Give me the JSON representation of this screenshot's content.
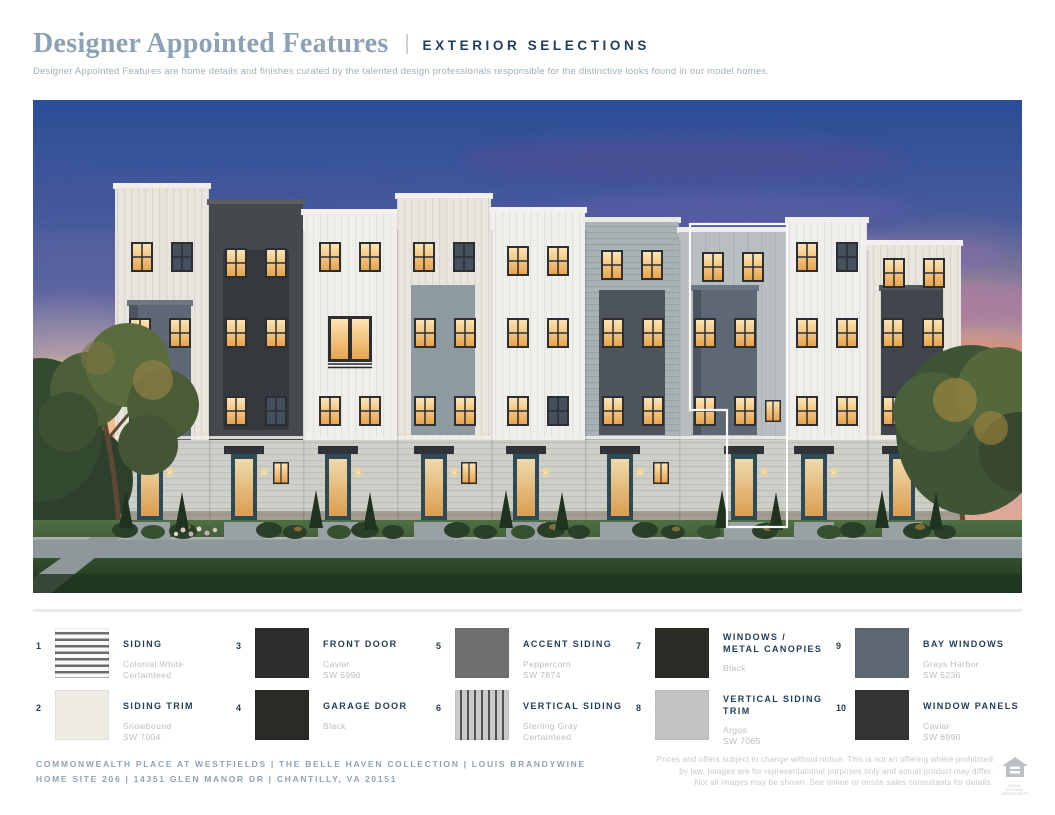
{
  "header": {
    "title": "Designer Appointed Features",
    "section_label": "EXTERIOR SELECTIONS",
    "description": "Designer Appointed Features are home details and finishes curated by the talented design professionals responsible for the distinctive looks found in our model homes."
  },
  "legend": {
    "items": [
      {
        "number": "1",
        "label": "SIDING",
        "sub": "Colonial White\nCertainteed",
        "color": "#f7f6f3",
        "pattern": "h-lines"
      },
      {
        "number": "2",
        "label": "SIDING TRIM",
        "sub": "Snowbound\nSW 7004",
        "color": "#edebe4"
      },
      {
        "number": "3",
        "label": "FRONT DOOR",
        "sub": "Caviar\nSW 6990",
        "color": "#2e2d2e"
      },
      {
        "number": "4",
        "label": "GARAGE DOOR",
        "sub": "Black",
        "color": "#2a2b26"
      },
      {
        "number": "5",
        "label": "ACCENT SIDING",
        "sub": "Peppercorn\nSW 7674",
        "color": "#6e6f71"
      },
      {
        "number": "6",
        "label": "VERTICAL SIDING",
        "sub": "Sterling Gray\nCertainteed",
        "color": "#c7c8c9",
        "pattern": "v-lines"
      },
      {
        "number": "7",
        "label": "WINDOWS /\nMETAL CANOPIES",
        "sub": "Black",
        "color": "#2b2c26"
      },
      {
        "number": "8",
        "label": "VERTICAL SIDING\nTRIM",
        "sub": "Argos\nSW 7065",
        "color": "#c3c4c2"
      },
      {
        "number": "9",
        "label": "BAY WINDOWS",
        "sub": "Grays Harbor\nSW 6236",
        "color": "#5d6671"
      },
      {
        "number": "10",
        "label": "WINDOW PANELS",
        "sub": "Caviar\nSW 6990",
        "color": "#323334"
      }
    ]
  },
  "footer": {
    "line1": "COMMONWEALTH PLACE AT WESTFIELDS   |   THE BELLE HAVEN COLLECTION   |   LOUIS BRANDYWINE",
    "line2": "HOME SITE 206   |   14351 GLEN MANOR DR   |   CHANTILLY, VA 20151",
    "disclaimer": "Prices and offers subject to change without notice. This is not an offering where prohibited\nby law. Images are for representational purposes only and actual product may differ.\nNot all images may be shown. See online or onsite sales consultants for details.",
    "eho_label": "EQUAL HOUSING\nOPPORTUNITY"
  },
  "colors": {
    "accent_navy": "#1e3c5c",
    "title_slate": "#8ca1b3",
    "muted_text": "#b7bdc3",
    "footer_slate": "#8ea3b2"
  }
}
